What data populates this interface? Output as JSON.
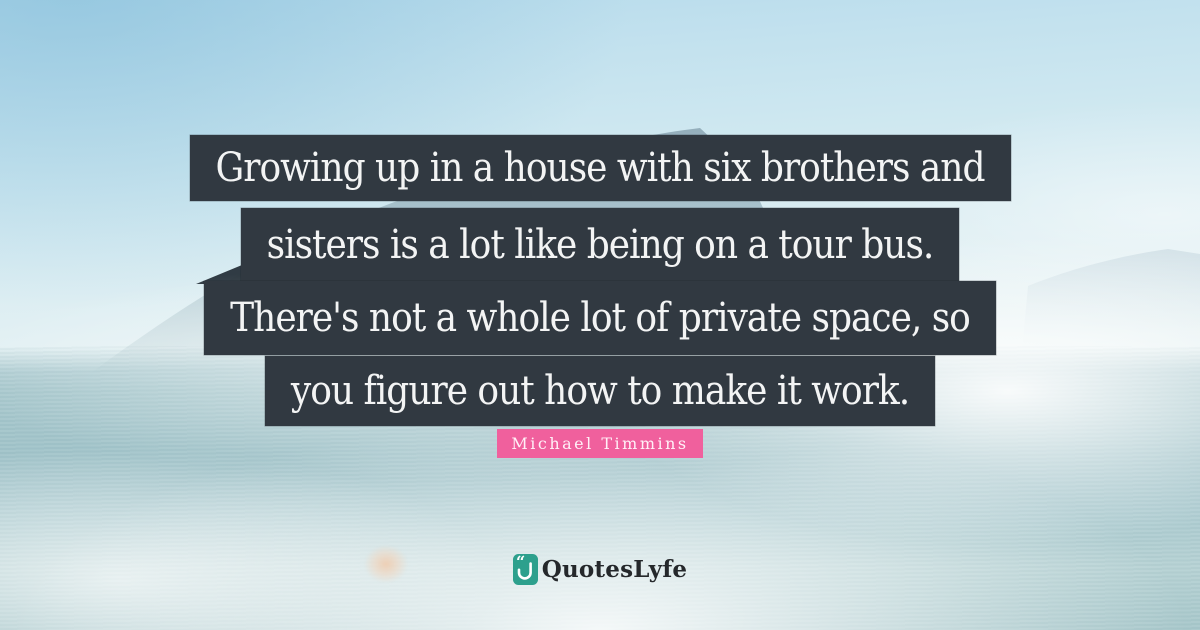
{
  "page": {
    "kind": "quote-card",
    "width_px": 1200,
    "height_px": 630
  },
  "quote": {
    "lines": [
      "Growing up in a house with six brothers and",
      "sisters is a lot like being on a tour bus.",
      "There's not a whole lot of private space, so",
      "you figure out how to make it work."
    ],
    "full_text": "Growing up in a house with six brothers and sisters is a lot like being on a tour bus. There's not a whole lot of private space, so you figure out how to make it work.",
    "author": "Michael Timmins"
  },
  "branding": {
    "logo_text": "QuotesLyfe",
    "logo_icon": "quoteslyfe-quote-hook-icon"
  },
  "background": {
    "description": "hazy coastal photo: blue sky, mountain slope descending left, faint ridge right, teal sea with white fog, small lens flare"
  },
  "colors": {
    "strip_bg": "#313941",
    "quote_text": "#f3f4f4",
    "author_bg": "#f0609d",
    "author_text": "#fff0f7",
    "logo_teal": "#2da08d",
    "logo_text_color": "#25282b",
    "sky_top": "#b5daeb",
    "sea_mid": "#a2c4ca",
    "dark_peak": "#27323a"
  }
}
